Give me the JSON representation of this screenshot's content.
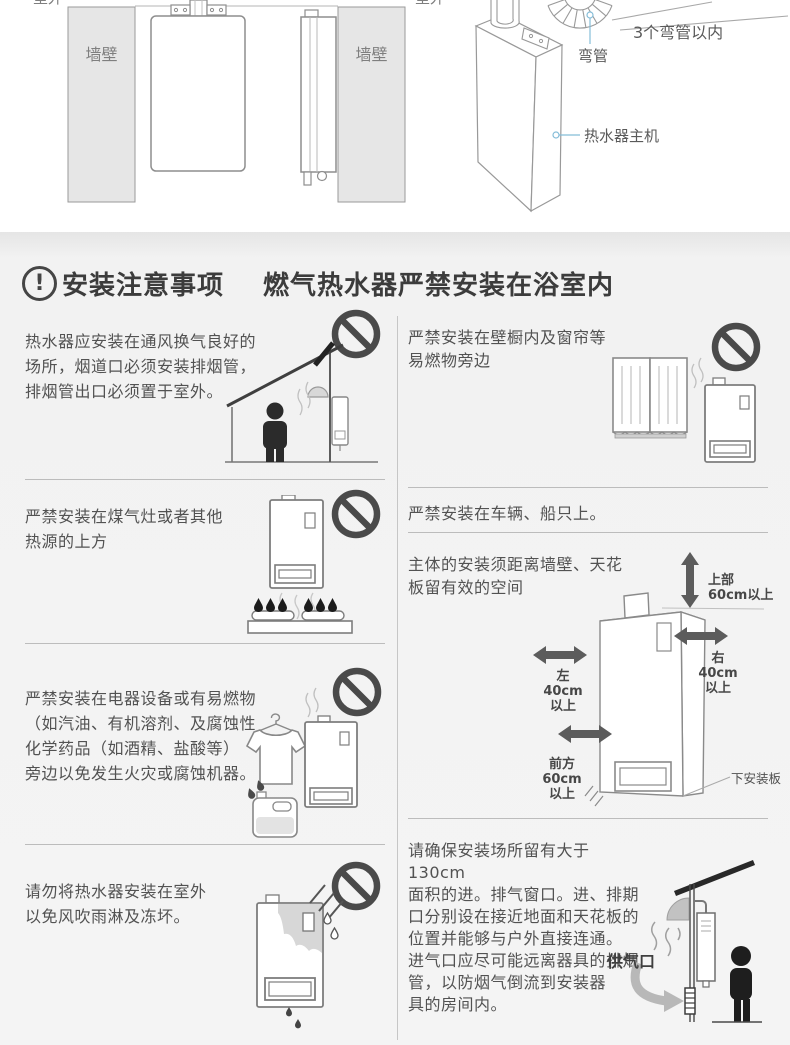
{
  "top_panel": {
    "outdoor_left": "室外",
    "outdoor_right": "室外",
    "wall_front": "墙壁",
    "wall_side": "墙壁",
    "bend_pipe": "弯管",
    "bend_limit": "3个弯管以内",
    "main_unit": "热水器主机",
    "illustrations": [
      "wall-mount-front-view",
      "wall-mount-side-view",
      "heater-3d-with-flue-elbow"
    ]
  },
  "header": {
    "icon": "alert-exclamation-circle-icon",
    "icon_glyph": "!",
    "title": "安装注意事项",
    "subtitle": "燃气热水器严禁安装在浴室内"
  },
  "left_column": {
    "sections": [
      {
        "text": "热水器应安装在通风换气良好的场所，烟道口必须安装排烟管，排烟管出口必须置于室外。",
        "lines": [
          "热水器应安装在通风换气良好的",
          "场所，烟道口必须安装排烟管，",
          "排烟管出口必须置于室外。"
        ],
        "illustration": "house-with-vent-and-person",
        "prohibition_sign": true
      },
      {
        "text": "严禁安装在煤气灶或者其他热源的上方",
        "lines": [
          "严禁安装在煤气灶或者其他",
          "热源的上方"
        ],
        "illustration": "heater-above-gas-stove",
        "prohibition_sign": true
      },
      {
        "text": "严禁安装在电器设备或有易燃物（如汽油、有机溶剂、及腐蚀性化学药品（如酒精、盐酸等）旁边以免发生火灾或腐蚀机器。",
        "lines": [
          "严禁安装在电器设备或有易燃物",
          "（如汽油、有机溶剂、及腐蚀性",
          "化学药品（如酒精、盐酸等）",
          "旁边以免发生火灾或腐蚀机器。"
        ],
        "illustration": "clothes-fuel-can-heater",
        "prohibition_sign": true
      },
      {
        "text": "请勿将热水器安装在室外以免风吹雨淋及冻坏。",
        "lines": [
          "请勿将热水器安装在室外",
          "以免风吹雨淋及冻坏。"
        ],
        "illustration": "heater-in-rain",
        "prohibition_sign": true
      }
    ]
  },
  "right_column": {
    "sections": [
      {
        "text": "严禁安装在壁橱内及窗帘等易燃物旁边",
        "lines": [
          "严禁安装在壁橱内及窗帘等",
          "易燃物旁边"
        ],
        "illustration": "curtains-and-heater",
        "prohibition_sign": true
      },
      {
        "text": "严禁安装在车辆、船只上。",
        "lines": [
          "严禁安装在车辆、船只上。"
        ],
        "prohibition_sign": false
      },
      {
        "text": "主体的安装须距离墙壁、天花板留有效的空间",
        "lines": [
          "主体的安装须距离墙壁、天花",
          "板留有效的空间"
        ],
        "illustration": "clearance-diagram",
        "clearances": {
          "top": [
            "上部",
            "60cm以上"
          ],
          "left": [
            "左",
            "40cm",
            "以上"
          ],
          "right": [
            "右",
            "40cm",
            "以上"
          ],
          "front": [
            "前方",
            "60cm",
            "以上"
          ],
          "bottom_plate": "下安装板"
        }
      },
      {
        "text": "请确保安装场所留有大于130cm面积的进。排气窗口。进、排期口分别设在接近地面和天花板的位置并能够与户外直接连通。进气口应尽可能远离器具的排烟管，以防烟气倒流到安装器具的房间内。",
        "lines": [
          "请确保安装场所留有大于130cm",
          "面积的进。排气窗口。进、排期",
          "口分别设在接近地面和天花板的",
          "位置并能够与户外直接连通。",
          "进气口应尽可能远离器具的排烟",
          "管，以防烟气倒流到安装器",
          "具的房间内。"
        ],
        "illustration": "outdoor-wall-gas-inlet-person",
        "gas_inlet": "供气口"
      }
    ]
  },
  "colors": {
    "body_text": "#525252",
    "title_text": "#3c3c3c",
    "prohibition_sign": "#4a4a4a",
    "section_background": "#f2f2f2",
    "divider": "#bcbcbc",
    "leader_line": "#85bdd8",
    "clearance_arrow": "#5c5c5c"
  }
}
